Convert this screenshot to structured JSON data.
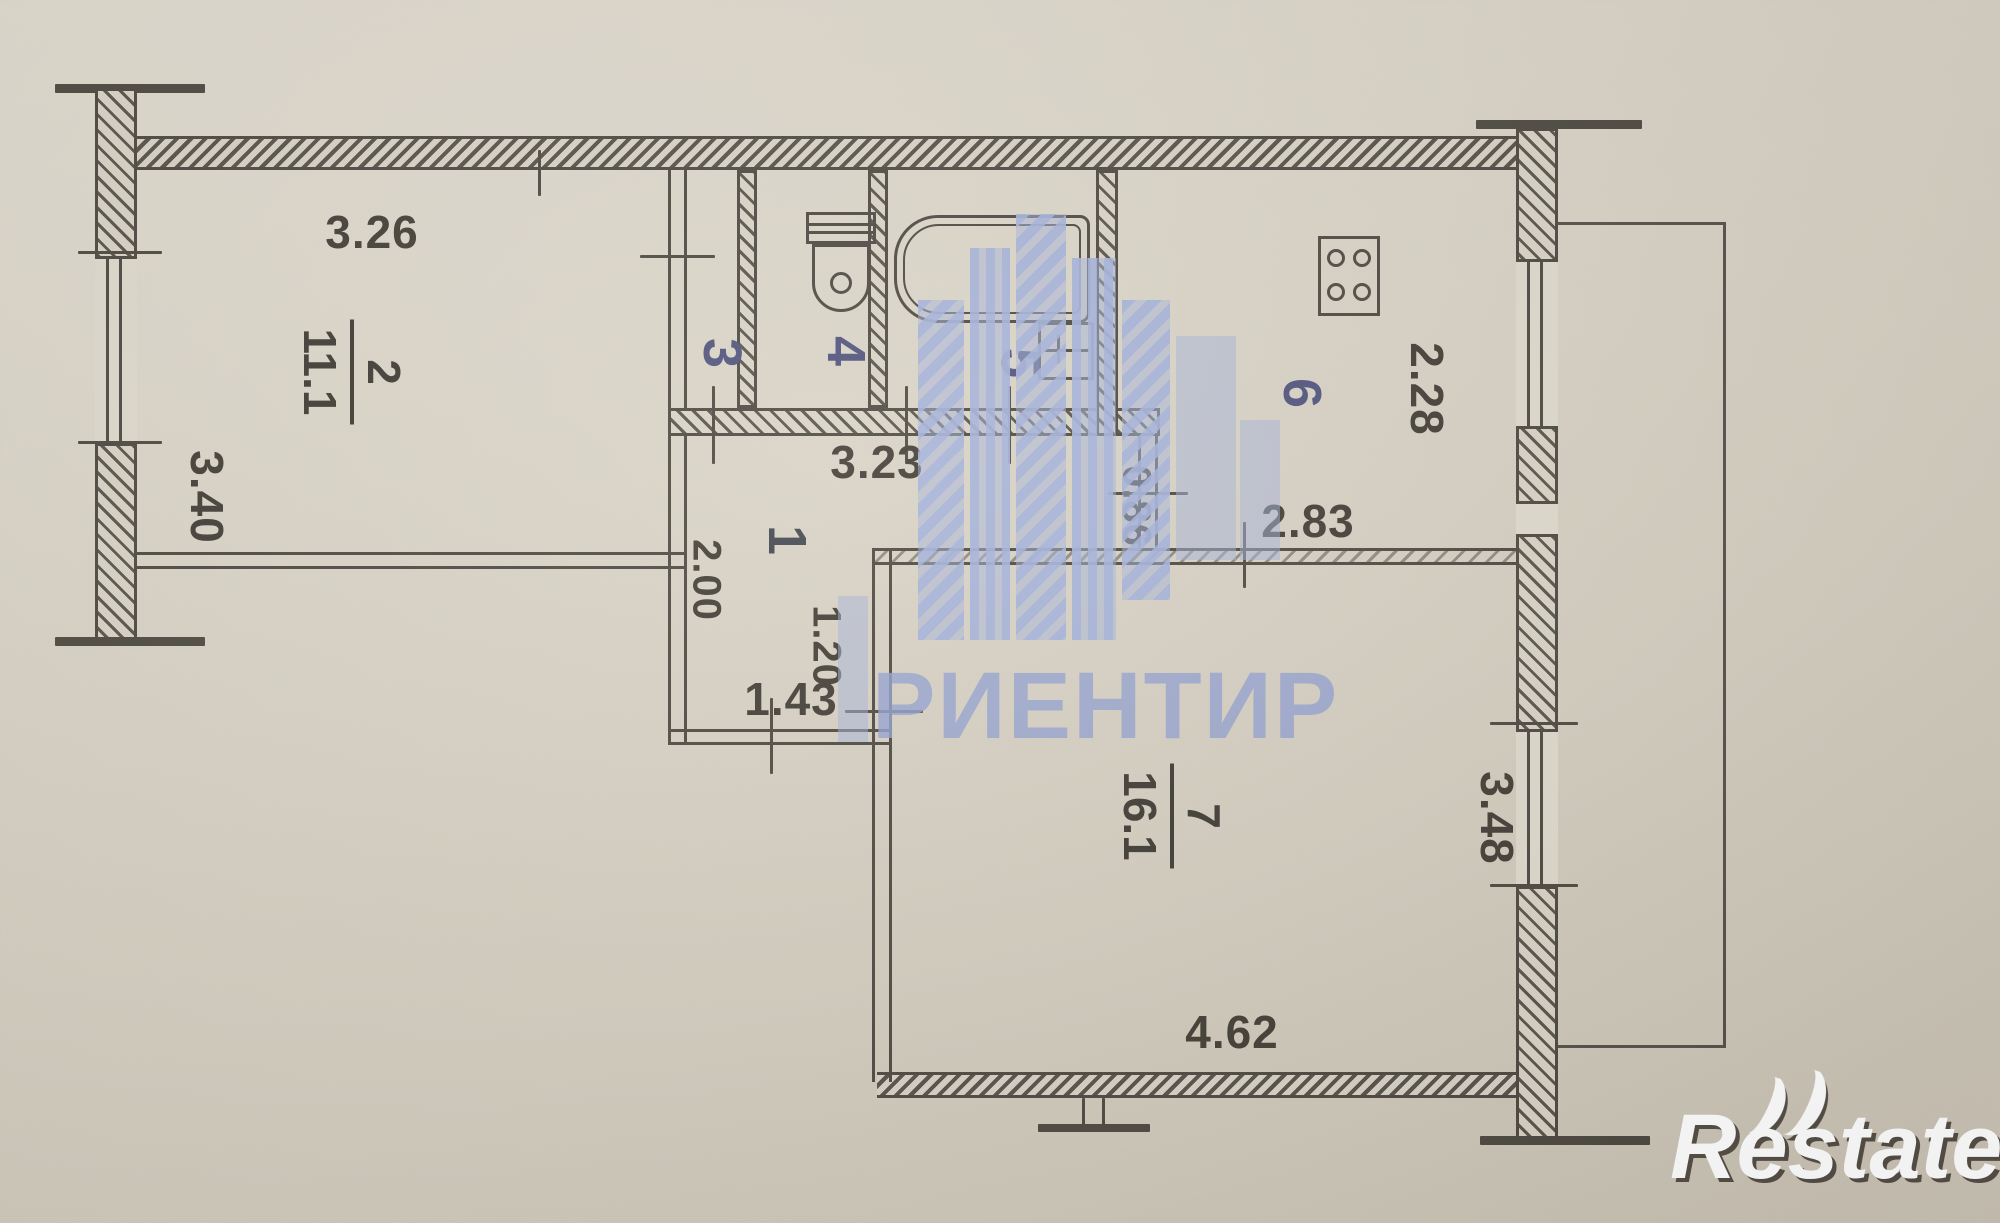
{
  "rooms": [
    {
      "number": "1"
    },
    {
      "number": "2",
      "area": "11.1"
    },
    {
      "number": "3"
    },
    {
      "number": "4"
    },
    {
      "number": "5"
    },
    {
      "number": "6"
    },
    {
      "number": "7",
      "area": "16.1"
    }
  ],
  "dimensions": {
    "room2_top": "3.26",
    "room2_left": "3.40",
    "hall_top": "3.23",
    "hall_left": "2.00",
    "hall_mid": "1.20",
    "hall_bottom": "1.43",
    "kitchen_entry": "0.86",
    "kitchen_bottom": "2.83",
    "kitchen_right": "2.28",
    "room7_right": "3.48",
    "room7_bottom": "4.62"
  },
  "watermark": {
    "agency": "РИЕНТИР"
  },
  "logo": {
    "r": "R",
    "rest": "estate"
  }
}
